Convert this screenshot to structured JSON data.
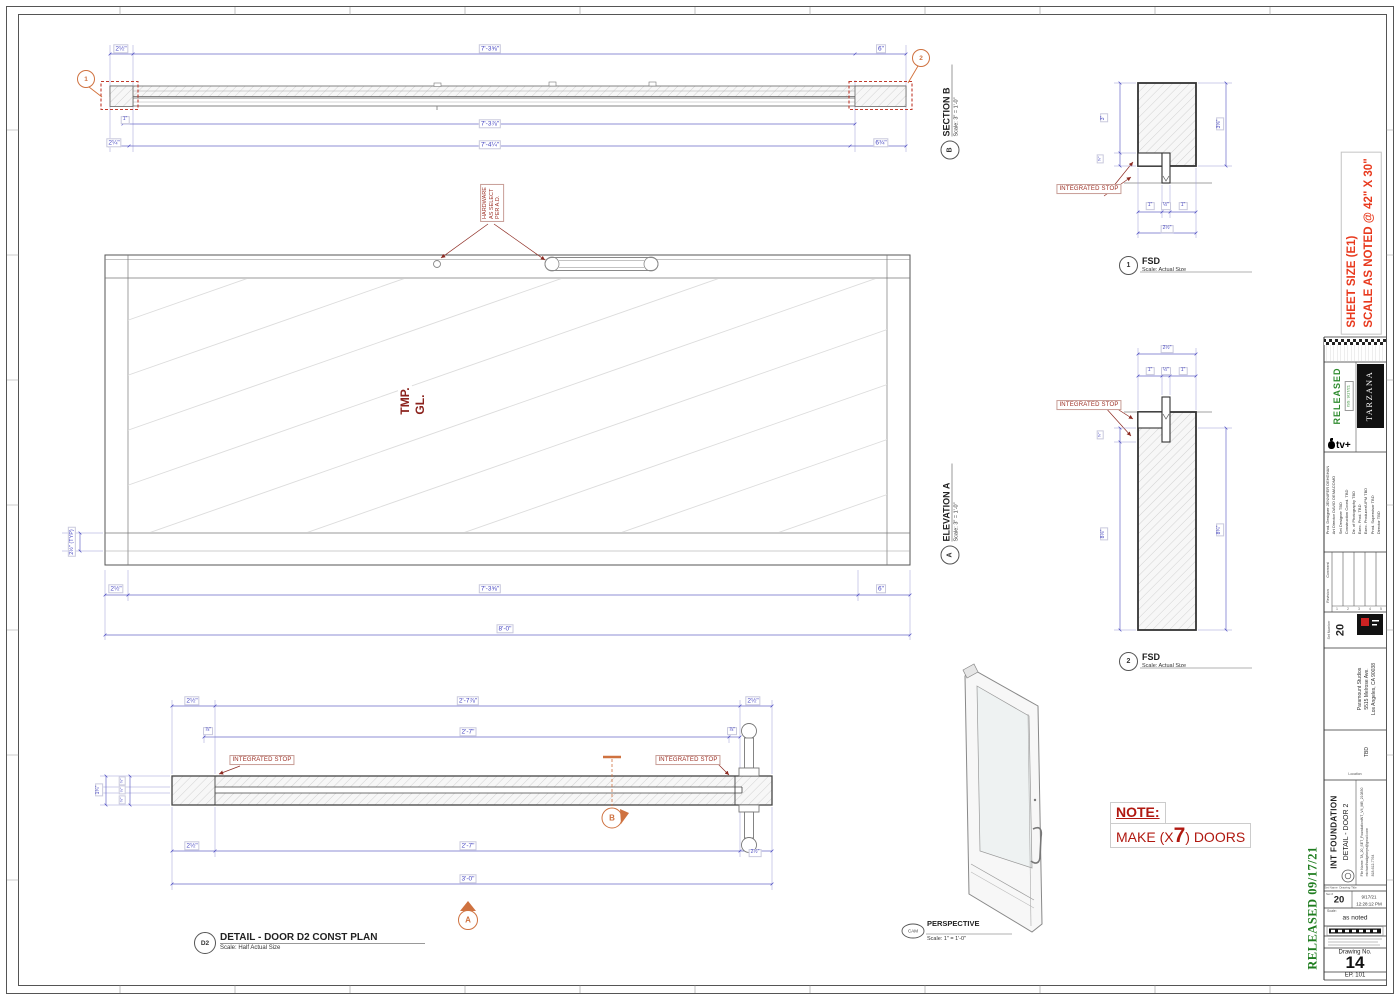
{
  "common": {
    "integrated_stop": "INTEGRATED STOP"
  },
  "section_b": {
    "title": "SECTION B",
    "scale": "Scale: 3\" = 1'-0\"",
    "tag": "B",
    "callout_left": "1",
    "callout_right": "2",
    "dims": {
      "stile": "2½\"",
      "span_top": "7'-3⅝\"",
      "right_top": "6\"",
      "glass_inset": "1\"",
      "span_mid": "7'-3⅞\"",
      "left_bot": "2¼\"",
      "span_bot": "7'-4¼\"",
      "right_bot": "6¾\""
    }
  },
  "elevation_a": {
    "title": "ELEVATION A",
    "scale": "Scale: 3\" = 1'-0\"",
    "tag": "A",
    "glass1": "TMP.",
    "glass2": "GL.",
    "hw1": "HARDWARE",
    "hw2": "AS SELECT",
    "hw3": "PER A.D.",
    "dims": {
      "rail_typ": "2½\" (TYP)",
      "stile": "2½\"",
      "span": "7'-3⅝\"",
      "right": "6\"",
      "overall": "8'-0\""
    }
  },
  "detail_d2": {
    "tag": "D2",
    "title": "DETAIL - DOOR D2 CONST PLAN",
    "scale": "Scale: Half Actual Size",
    "marker_a": "A",
    "marker_b": "B",
    "dims": {
      "t_stile": "2½\"",
      "t_span": "2'-7⅞\"",
      "t_rstile": "2½\"",
      "t_glass": "⅞\"",
      "t_span2": "2'-7\"",
      "r_glass": "⅞\"",
      "b_stile": "2½\"",
      "b_span": "2'-7\"",
      "b_rstile": "2½\"",
      "b_overall": "3'-0\"",
      "th1": "¾\"",
      "th2": "¼\"",
      "th3": "¾\"",
      "th_total": "1¾\""
    }
  },
  "fsd1": {
    "num": "1",
    "title": "FSD",
    "scale": "Scale: Actual Size",
    "dims": {
      "left_main": "3\"",
      "left_step": "⅝\"",
      "right": "3⅝\"",
      "b1": "1\"",
      "b2": "½\"",
      "b3": "1\"",
      "b_total": "2½\""
    }
  },
  "fsd2": {
    "num": "2",
    "title": "FSD",
    "scale": "Scale: Actual Size",
    "dims": {
      "t_total": "2½\"",
      "t1": "1\"",
      "t2": "½\"",
      "t3": "1\"",
      "left_step": "⅝\"",
      "left_main": "8⅛\"",
      "right": "8¾\""
    }
  },
  "perspective": {
    "tag": "CAM",
    "title": "PERSPECTIVE",
    "scale": "Scale: 1\" = 1'-0\""
  },
  "note": {
    "title": "NOTE:",
    "pre": "MAKE (X",
    "big": "7",
    "post": ") DOORS"
  },
  "stamps": {
    "sheet_size1": "SHEET SIZE (E1)",
    "sheet_size2": "SCALE AS NOTED @ 42\" X 30\"",
    "released": "RELEASED  09/17/21"
  },
  "title_block": {
    "released": "RELEASED",
    "iss": "ISS: 9/17/21",
    "show": "TARZANA",
    "network": "tv+",
    "credits_l1": "Prod. Designer   JENNIFER DEHGHAN",
    "credits_l2": "Art Director   DAVID DEMACOMO",
    "credits_l3": "Set Designer   TBD",
    "credits_l4": "Construction Coord.   TBD",
    "credits_l5": "Dir. of Photography   TBD",
    "credits_l6": "Exec. Prod.   TBD",
    "credits_l7": "Exec. Producer/UPM   TBD",
    "credits_l8": "Prod. Supervisor   TBD",
    "credits_l9": "Director   TBD",
    "rev_label": "Revision",
    "com_label": "Comment",
    "rev1": "1",
    "rev2": "2",
    "rev3": "3",
    "rev4": "4",
    "rev5": "5",
    "set_number_label": "Set Number",
    "set_number": "20",
    "addr1": "Paramount Studios",
    "addr2": "5515 Melrose Ave.",
    "addr3": "Los Angeles, CA 90038",
    "location_label": "Location",
    "location_value": "TBD",
    "set_name_label": "Set Name",
    "drawing_title_label": "Drawing Title",
    "set_name": "INT FOUNDATION",
    "drawing_title": "DETAIL - DOOR 2",
    "file_name": "File Name:  TA_20_SET_FoundationINT_V4_MB_210830",
    "email": "michaelhodgekeys@gmail.com",
    "phone": "818-612-7764",
    "set_hash_label": "Set #",
    "set_hash": "20",
    "date": "9/17/21",
    "time": "12:28:12 PM",
    "scale_label": "Scale:",
    "scale_value": "as noted",
    "drawing_no_label": "Drawing No.",
    "drawing_no": "14",
    "episode": "EP. 101"
  }
}
